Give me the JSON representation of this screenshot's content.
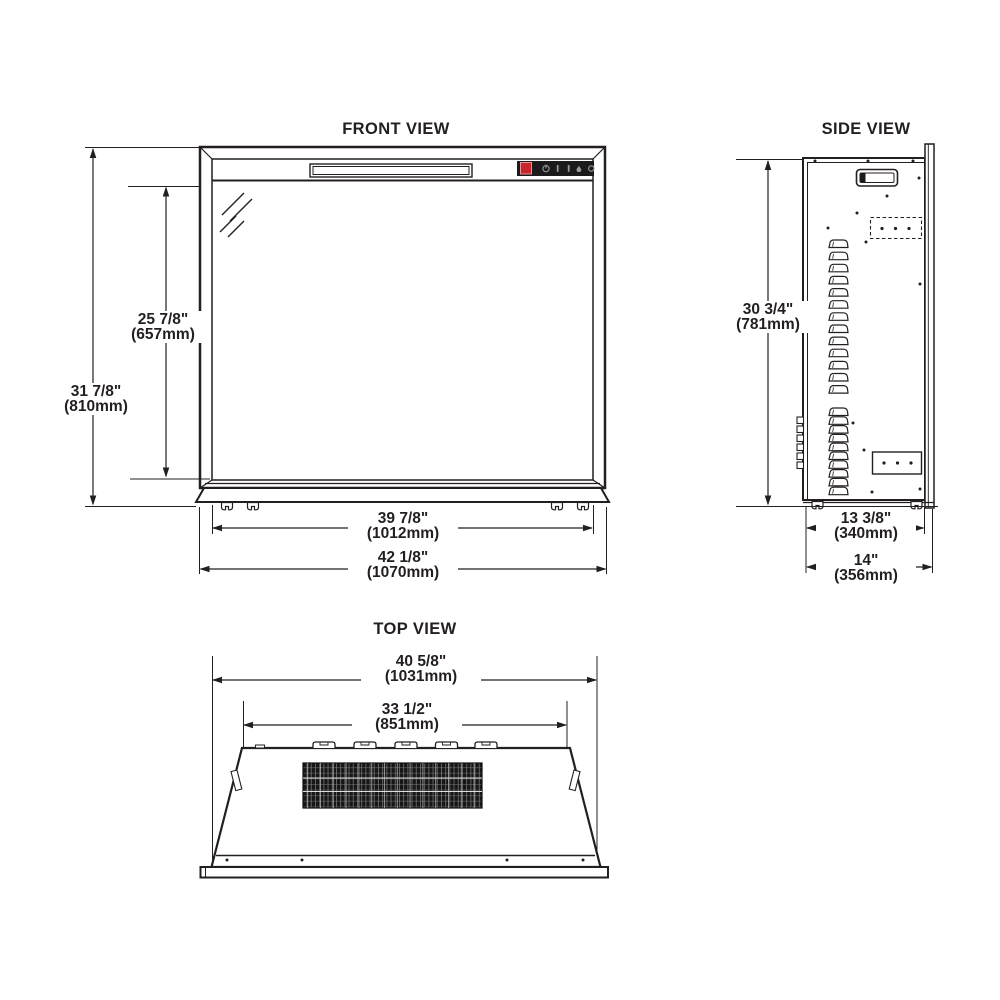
{
  "drawing": {
    "background": "#ffffff",
    "line_color": "#231f20",
    "views": {
      "front": {
        "title": "FRONT VIEW",
        "dims": {
          "overall_height": {
            "in": "31 7/8\"",
            "mm": "(810mm)"
          },
          "glass_height": {
            "in": "25 7/8\"",
            "mm": "(657mm)"
          },
          "glass_width": {
            "in": "39 7/8\"",
            "mm": "(1012mm)"
          },
          "overall_width": {
            "in": "42 1/8\"",
            "mm": "(1070mm)"
          }
        },
        "control_panel": {
          "power_button_color": "#c8242b",
          "icons": [
            "power-icon",
            "control-icon-2",
            "control-icon-3",
            "flame-icon",
            "control-icon-5"
          ]
        }
      },
      "side": {
        "title": "SIDE VIEW",
        "dims": {
          "overall_height": {
            "in": "30 3/4\"",
            "mm": "(781mm)"
          },
          "body_depth": {
            "in": "13 3/8\"",
            "mm": "(340mm)"
          },
          "overall_depth": {
            "in": "14\"",
            "mm": "(356mm)"
          }
        }
      },
      "top": {
        "title": "TOP VIEW",
        "dims": {
          "flange_width": {
            "in": "40 5/8\"",
            "mm": "(1031mm)"
          },
          "body_width": {
            "in": "33 1/2\"",
            "mm": "(851mm)"
          }
        }
      }
    }
  }
}
